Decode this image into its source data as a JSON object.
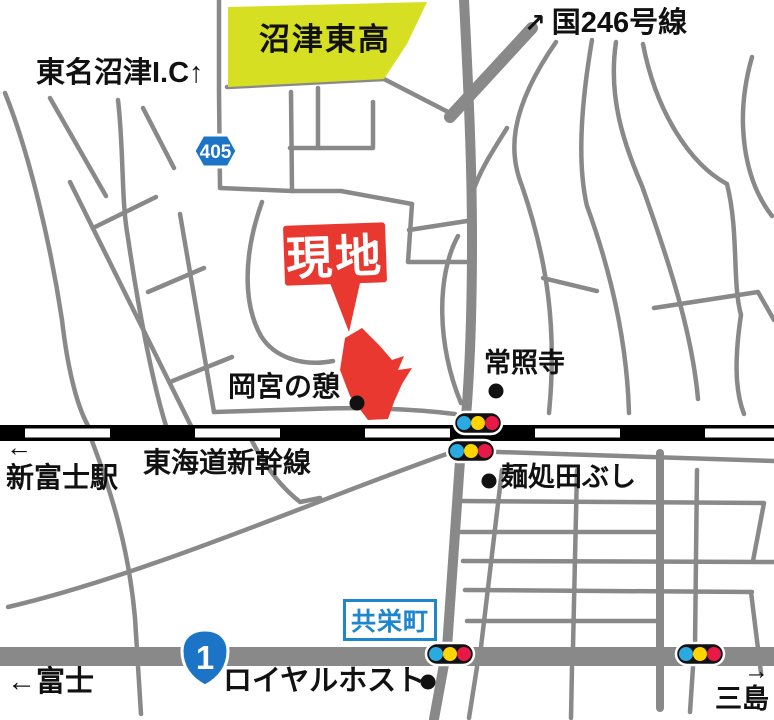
{
  "map": {
    "colors": {
      "road_gray": "#898989",
      "school_fill": "#d7df23",
      "site_red": "#e8382f",
      "rail_black": "#000000",
      "shield_blue": "#1b74c6",
      "kyoei_blue": "#1d86cc",
      "signal_body": "#111111",
      "signal_cyan": "#29abe2",
      "signal_yellow": "#ffd400",
      "signal_red": "#e61947",
      "dot_black": "#111111"
    },
    "labels": {
      "tomei_ic": "東名沼津I.C↑",
      "school": "沼津東高",
      "route246_arrow": "↗",
      "route246": "国246号線",
      "route405": "405",
      "site": "現地",
      "okamiya": "岡宮の憩",
      "joshoji": "常照寺",
      "shinfuji_arrow": "←",
      "shinfuji_station": "新富士駅",
      "shinkansen": "東海道新幹線",
      "tabushi": "麺処田ぶし",
      "kyoeicho": "共栄町",
      "route1": "1",
      "fuji": "←富士",
      "royal_host": "ロイヤルホスト",
      "mishima_arrow": "→",
      "mishima": "三島"
    }
  }
}
